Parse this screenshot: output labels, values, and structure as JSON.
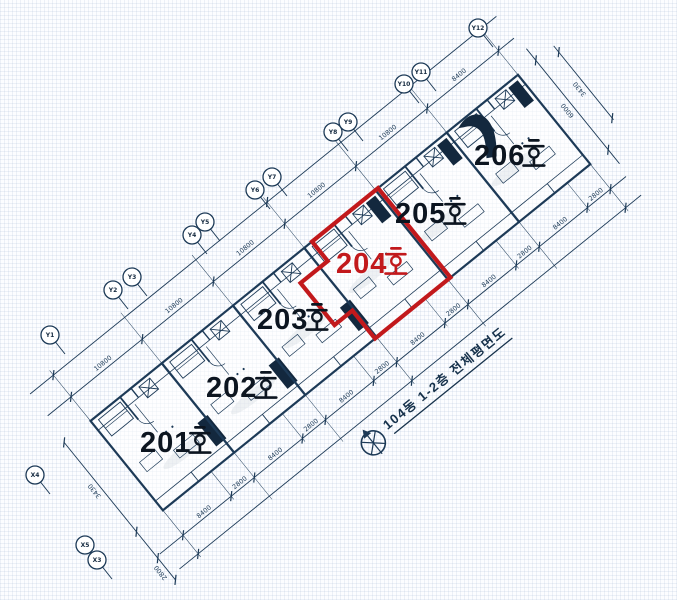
{
  "drawing": {
    "caption": "104동 1-2층 전체평면도",
    "highlighted_unit": "204호"
  },
  "units": [
    {
      "label": "201호",
      "number": "201",
      "suffix": "호",
      "x": 186,
      "y": 440,
      "highlighted": false
    },
    {
      "label": "202호",
      "number": "202",
      "suffix": "호",
      "x": 252,
      "y": 385,
      "highlighted": false
    },
    {
      "label": "203호",
      "number": "203",
      "suffix": "호",
      "x": 303,
      "y": 317,
      "highlighted": false
    },
    {
      "label": "204호",
      "number": "204",
      "suffix": "호",
      "x": 382,
      "y": 261,
      "highlighted": true
    },
    {
      "label": "205호",
      "number": "205",
      "suffix": "호",
      "x": 441,
      "y": 211,
      "highlighted": false
    },
    {
      "label": "206호",
      "number": "206",
      "suffix": "호",
      "x": 520,
      "y": 153,
      "highlighted": false
    }
  ],
  "axis_markers": [
    {
      "label": "Y1",
      "x": 50,
      "y": 335
    },
    {
      "label": "Y2",
      "x": 113,
      "y": 290
    },
    {
      "label": "Y3",
      "x": 132,
      "y": 277
    },
    {
      "label": "Y4",
      "x": 192,
      "y": 235
    },
    {
      "label": "Y5",
      "x": 205,
      "y": 222
    },
    {
      "label": "Y6",
      "x": 255,
      "y": 190
    },
    {
      "label": "Y7",
      "x": 272,
      "y": 177
    },
    {
      "label": "Y8",
      "x": 333,
      "y": 132
    },
    {
      "label": "Y9",
      "x": 348,
      "y": 122
    },
    {
      "label": "Y10",
      "x": 404,
      "y": 84
    },
    {
      "label": "Y11",
      "x": 421,
      "y": 72
    },
    {
      "label": "Y12",
      "x": 478,
      "y": 28
    },
    {
      "label": "X4",
      "x": 35,
      "y": 475
    },
    {
      "label": "X5",
      "x": 85,
      "y": 545
    },
    {
      "label": "X3",
      "x": 97,
      "y": 560
    }
  ],
  "dimension_labels": {
    "upper": [
      "10800",
      "10800",
      "10800",
      "10800",
      "10800",
      "8400"
    ],
    "lower": [
      "8400",
      "2800",
      "8400",
      "2800",
      "8400",
      "2800",
      "8400",
      "2800",
      "8400",
      "2800",
      "8400",
      "2800"
    ],
    "right": [
      "6000",
      "3430"
    ],
    "left": [
      "3430",
      "2800"
    ]
  },
  "colors": {
    "ink": "#1d3a57",
    "label": "#0c1520",
    "highlight": "#c2191c",
    "background": "#fcfdff"
  }
}
